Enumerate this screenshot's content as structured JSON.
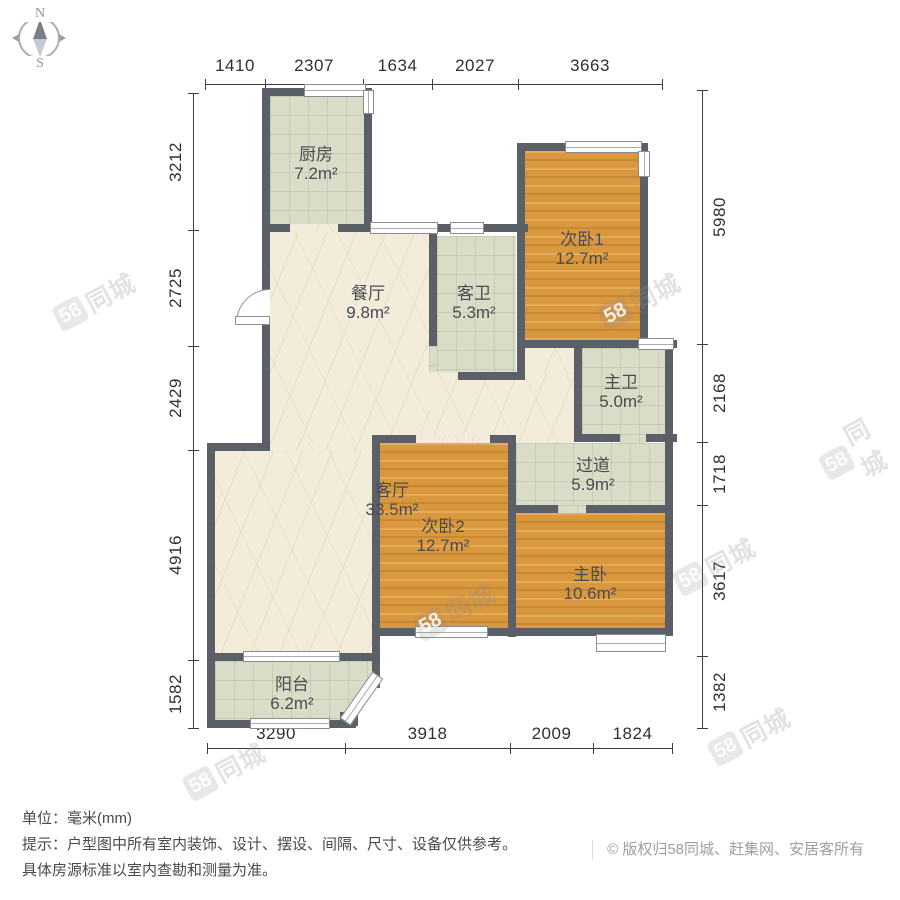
{
  "compass": {
    "north": "N",
    "south": "S"
  },
  "dimensions": {
    "top": [
      "1410",
      "2307",
      "1634",
      "2027",
      "3663"
    ],
    "left": [
      "3212",
      "2725",
      "2429",
      "4916",
      "1582"
    ],
    "right": [
      "5980",
      "2168",
      "1718",
      "3617",
      "1382"
    ],
    "bottom": [
      "3290",
      "3918",
      "2009",
      "1824"
    ]
  },
  "rooms": [
    {
      "id": "kitchen",
      "name": "厨房",
      "area": "7.2m²"
    },
    {
      "id": "dining",
      "name": "餐厅",
      "area": "9.8m²"
    },
    {
      "id": "guest-bath",
      "name": "客卫",
      "area": "5.3m²"
    },
    {
      "id": "bedroom2-1",
      "name": "次卧1",
      "area": "12.7m²"
    },
    {
      "id": "master-bath",
      "name": "主卫",
      "area": "5.0m²"
    },
    {
      "id": "hallway",
      "name": "过道",
      "area": "5.9m²"
    },
    {
      "id": "living",
      "name": "客厅",
      "area": "33.5m²"
    },
    {
      "id": "bedroom2-2",
      "name": "次卧2",
      "area": "12.7m²"
    },
    {
      "id": "master-bedroom",
      "name": "主卧",
      "area": "10.6m²"
    },
    {
      "id": "balcony",
      "name": "阳台",
      "area": "6.2m²"
    }
  ],
  "watermark": {
    "logo": "58",
    "text": "同城"
  },
  "footer": {
    "unit": "单位：毫米(mm)",
    "tip_line1": "提示：户型图中所有室内装饰、设计、摆设、间隔、尺寸、设备仅供参考。",
    "tip_line2": "具体房源标准以室内查勘和测量为准。",
    "copyright_symbol": "©",
    "copyright": "版权归58同城、赶集网、安居客所有"
  },
  "colors": {
    "wall": "#5b6066",
    "tile": "#d9dcc6",
    "wood": "#d9973e",
    "marble": "#f4ecda"
  }
}
